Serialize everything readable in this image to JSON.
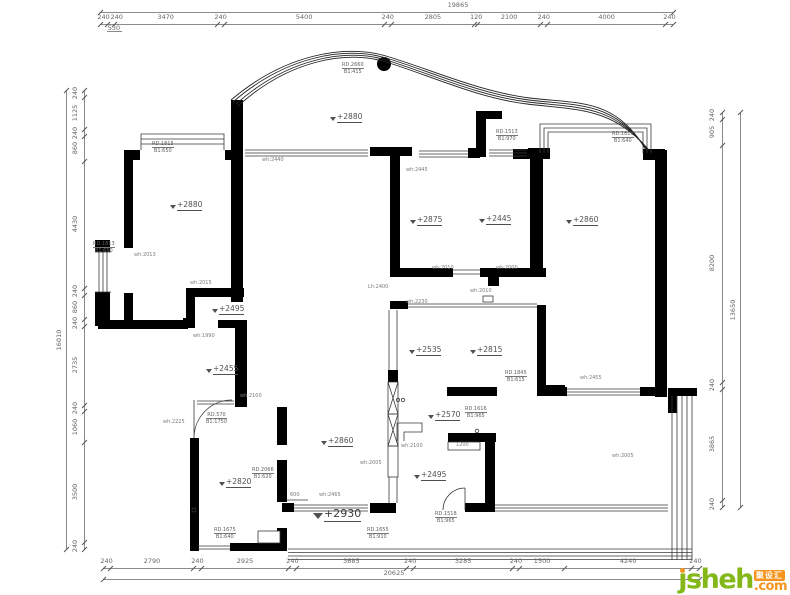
{
  "watermark": {
    "brand": "jsheh",
    "brand_dotless": "ȷsheh",
    "suffix": ".com",
    "badge": "聚设汇",
    "green": "#84b819",
    "orange": "#f7941e"
  },
  "colors": {
    "wall": "#000000",
    "thin_line": "#3a3a3a",
    "dim_text": "#666666"
  },
  "dimensions": {
    "top": {
      "segments": [
        "240",
        "240",
        "3470",
        "240",
        "5400",
        "240",
        "2805",
        "120",
        "2100",
        "240",
        "4000",
        "240"
      ],
      "overall": "19865",
      "sub": "530"
    },
    "bottom": {
      "segments": [
        "240",
        "2790",
        "240",
        "2925",
        "240",
        "3685",
        "240",
        "3285",
        "240",
        "1500",
        "4240",
        "240"
      ],
      "overall": "20625"
    },
    "left": {
      "segments": [
        "240",
        "1125",
        "240",
        "860",
        "4430",
        "240",
        "860",
        "240",
        "2735",
        "240",
        "1060",
        "3500",
        "240"
      ],
      "overall": "16010"
    },
    "right": {
      "segments": [
        "240",
        "905",
        "8200",
        "240",
        "3865",
        "240"
      ],
      "overall": "13650"
    }
  },
  "plan": {
    "levels": [
      {
        "text": "+2880",
        "x": 330,
        "y": 112,
        "big": false
      },
      {
        "text": "+2880",
        "x": 170,
        "y": 200,
        "big": false
      },
      {
        "text": "+2875",
        "x": 410,
        "y": 215,
        "big": false
      },
      {
        "text": "+2445",
        "x": 479,
        "y": 214,
        "big": false
      },
      {
        "text": "+2860",
        "x": 566,
        "y": 215,
        "big": false
      },
      {
        "text": "+2495",
        "x": 212,
        "y": 304,
        "big": false
      },
      {
        "text": "+2535",
        "x": 409,
        "y": 345,
        "big": false
      },
      {
        "text": "+2815",
        "x": 470,
        "y": 345,
        "big": false
      },
      {
        "text": "+2455",
        "x": 206,
        "y": 364,
        "big": false
      },
      {
        "text": "+2570",
        "x": 428,
        "y": 410,
        "big": false
      },
      {
        "text": "+2860",
        "x": 321,
        "y": 436,
        "big": false
      },
      {
        "text": "+2820",
        "x": 219,
        "y": 477,
        "big": false
      },
      {
        "text": "+2495",
        "x": 414,
        "y": 470,
        "big": false
      },
      {
        "text": "+2930",
        "x": 313,
        "y": 507,
        "big": true
      }
    ],
    "tags": [
      {
        "line1": "RD.2660",
        "line2": "B1:415",
        "x": 342,
        "y": 62
      },
      {
        "line1": "RD.1815",
        "line2": "B1:650",
        "x": 152,
        "y": 141
      },
      {
        "line1": "RD.1513",
        "line2": "B1:970",
        "x": 496,
        "y": 129
      },
      {
        "line1": "RD.1813",
        "line2": "B1:640",
        "x": 612,
        "y": 131
      },
      {
        "line1": "RD.1813",
        "line2": "B1:650",
        "x": 93,
        "y": 241
      },
      {
        "line1": "RD.1845",
        "line2": "B1:615",
        "x": 505,
        "y": 370
      },
      {
        "line1": "RD.570",
        "line2": "B1:1750",
        "x": 206,
        "y": 412
      },
      {
        "line1": "RD.1616",
        "line2": "B1:965",
        "x": 465,
        "y": 406
      },
      {
        "line1": "RD.2066",
        "line2": "B1:620",
        "x": 252,
        "y": 467
      },
      {
        "line1": "RD.1518",
        "line2": "B1:965",
        "x": 435,
        "y": 511
      },
      {
        "line1": "RD.1675",
        "line2": "B1:640",
        "x": 214,
        "y": 527
      },
      {
        "line1": "RD.1655",
        "line2": "B1:910",
        "x": 367,
        "y": 527
      }
    ],
    "notes": [
      {
        "text": "wh:2440",
        "x": 262,
        "y": 157
      },
      {
        "text": "wh:2445",
        "x": 406,
        "y": 167
      },
      {
        "text": "wh:2013",
        "x": 134,
        "y": 252
      },
      {
        "text": "wh:2015",
        "x": 190,
        "y": 280
      },
      {
        "text": "wh:2010",
        "x": 432,
        "y": 265
      },
      {
        "text": "wh:2000",
        "x": 496,
        "y": 265
      },
      {
        "text": "Lh:2400",
        "x": 368,
        "y": 284
      },
      {
        "text": "wh:2010",
        "x": 470,
        "y": 288
      },
      {
        "text": "wh:2230",
        "x": 406,
        "y": 299
      },
      {
        "text": "wh:1990",
        "x": 193,
        "y": 333
      },
      {
        "text": "wh:2100",
        "x": 240,
        "y": 393
      },
      {
        "text": "wh:2455",
        "x": 580,
        "y": 375
      },
      {
        "text": "wh:2225",
        "x": 163,
        "y": 419
      },
      {
        "text": "wh:2100",
        "x": 401,
        "y": 443
      },
      {
        "text": "wh:2005",
        "x": 360,
        "y": 460
      },
      {
        "text": "wh:2465",
        "x": 319,
        "y": 492
      },
      {
        "text": "600",
        "x": 290,
        "y": 492
      },
      {
        "text": "1200",
        "x": 456,
        "y": 442
      },
      {
        "text": "wh:2005",
        "x": 612,
        "y": 453
      }
    ]
  }
}
